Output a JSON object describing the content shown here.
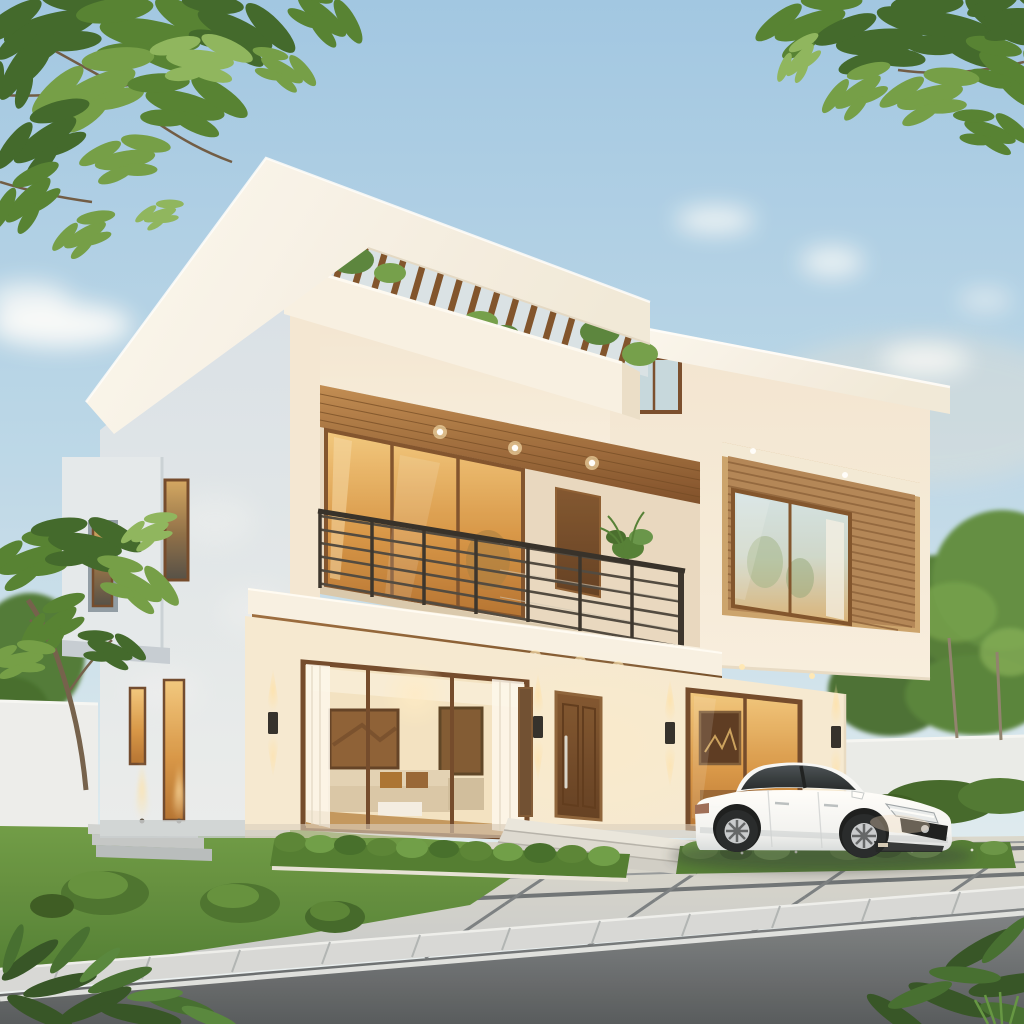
{
  "scene": {
    "title": "Modern Villa Exterior Rendering",
    "description": "Photorealistic dusk rendering of a modern two-storey white villa with flat cantilevered roofs, a rooftop pergola of wooden slats with terrace plants, a second-floor balcony with dark metal horizontal-bar railing and warm amber glazing, a wood-slat clad recessed bay on the right wing, a brown panelled entry door with steel handle, warmly lit living-room glazing showing sofas and framed art, wall sconces and recessed downlights, a landscaped lawn with hedges and shrubs, a grey paver driveway with a white sedan parked under the cantilevered right wing, a white boundary wall backed by trees, and an asphalt road in the foreground under a soft blue evening sky with scattered clouds and overhanging leafy branches in the top corners.",
    "time_of_day": "early evening dusk",
    "weather": "clear sky, scattered soft clouds"
  },
  "palette": {
    "sky_top": "#9ec7e6",
    "sky_horizon": "#eef4f6",
    "cloud": "#ffffff",
    "wall_sunlit": "#f6eedf",
    "wall_shadow": "#dde4ec",
    "roof_white": "#faf7f0",
    "wood_soffit": "#a06a38",
    "wood_dark": "#6e4522",
    "pergola_slat": "#7c4e27",
    "glass_warm": "#e9b468",
    "glass_warm_deep": "#b26f2e",
    "glass_cool": "#d3e4e9",
    "railing_metal": "#3a342e",
    "door_brown": "#7a4e2b",
    "sconce_black": "#2c2a27",
    "sconce_glow": "#ffdf9f",
    "lawn_green": "#5f9140",
    "hedge_green": "#4c7a2e",
    "foliage_dark": "#3a6527",
    "foliage_light": "#6f9c44",
    "paver_grey": "#cfd2d2",
    "paver_joint": "#6a7075",
    "curb_grey": "#d6d9da",
    "road_asphalt": "#5e646a",
    "road_line_white": "#e9ecec",
    "boundary_wall": "#e9eced",
    "car_body_white": "#ffffff",
    "car_glass": "#2a3137",
    "tire_black": "#1f2327"
  },
  "objects": {
    "house": {
      "storeys": 2,
      "style": "modern flat-roof villa",
      "features": [
        "cantilevered white roof slab",
        "rooftop wooden pergola with terrace plants",
        "balcony with horizontal metal railing",
        "wood-slat clad recessed bay on right wing",
        "wood plank soffits with recessed downlights",
        "brown panelled entry door with vertical steel handle",
        "floor-to-ceiling warm-lit glazing"
      ],
      "lighting": {
        "wall_sconces": 4,
        "balcony_downlights": 3,
        "canopy_downlights": 3,
        "ground_uplights": 2
      }
    },
    "interior_visible": [
      "two framed sepia artworks",
      "beige sectional sofa with brown cushions",
      "white coffee table",
      "sheer curtains"
    ],
    "car": {
      "type": "sedan",
      "color": "white",
      "facing": "right",
      "position": "parked on paver driveway under right wing"
    },
    "vegetation": [
      "overhanging branches top-left",
      "overhanging branches top-right",
      "tree on left lawn",
      "trees behind right boundary wall",
      "lawn",
      "box hedge under living window",
      "flower bed before car",
      "round shrubs on lawn",
      "foreground ferns both bottom corners"
    ],
    "hardscape": [
      "grey paver forecourt with dark joints",
      "entry steps",
      "side garden steps",
      "kerb",
      "asphalt road with white edge line",
      "white boundary walls"
    ]
  }
}
